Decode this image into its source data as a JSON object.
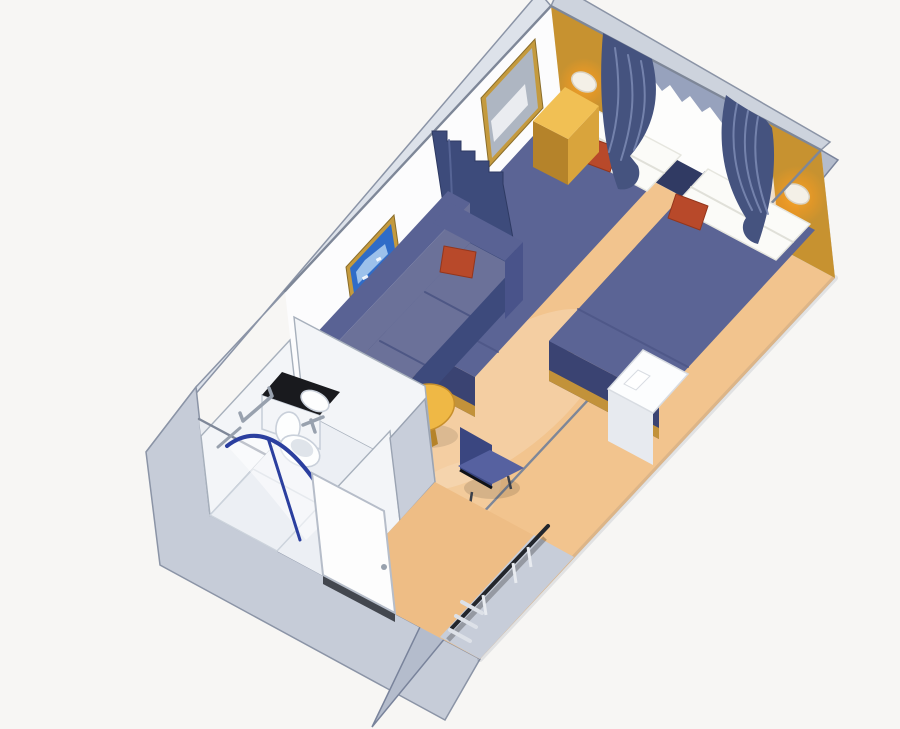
{
  "scene": {
    "title": "cruise-stateroom-3d-floorplan",
    "view": "isometric-cutaway",
    "rooms": [
      "sleeping-area",
      "sitting-area",
      "bathroom",
      "entry-corridor"
    ],
    "furniture": [
      "twin-bed-left",
      "twin-bed-right",
      "nightstand",
      "sofa",
      "coffee-table",
      "desk",
      "desk-chair",
      "wardrobe-closet",
      "vanity-sink",
      "toilet",
      "shower",
      "porthole-window",
      "window-curtains",
      "divider-drape",
      "wall-mirror",
      "framed-picture",
      "wall-sconce-left",
      "wall-sconce-right",
      "entry-door"
    ]
  },
  "palette": {
    "background": "#f7f6f4",
    "shell_left": "#dde2ea",
    "shell_bottom": "#c6ccd8",
    "shell_right": "#b4bccc",
    "shell_rim": "#cdd3dd",
    "wall_white": "#fcfcfd",
    "wall_end": "#e9ecf1",
    "wall_bath": "#f3f5f8",
    "window_backing": "#eef0f4",
    "window_white": "#fdfdfc",
    "gold_wall": "#c79230",
    "gold_top": "#f1c054",
    "gold_front": "#d9a43c",
    "gold_side": "#b5832a",
    "gold_trim": "#c2923a",
    "glow": "#f59b22",
    "lamp": "#f4f0e7",
    "navy_top": "#5b6495",
    "navy_side": "#4b5487",
    "navy_foot": "#3a4372",
    "navy_base": "#303a63",
    "curtain": "#45537f",
    "curtain_fold": "#7d8bb4",
    "valance": "#97a2bd",
    "drape": "#3d4b7b",
    "linen": "#fbfbf8",
    "linen_split": "#d9d9d1",
    "red": "#b8492a",
    "red_edge": "#93361d",
    "frame_gold": "#c49a3e",
    "picture_blue": "#2f6cc8",
    "picture_light": "#a8cbee",
    "mirror_glass": "#aeb6c2",
    "mirror_streak": "#f4f6f8",
    "sofa_seat": "#6b7199",
    "sofa_back": "#596294",
    "sofa_front": "#3d4a7c",
    "sofa_arm": "#49538a",
    "table_top": "#efb845",
    "table_rim": "#c78f2b",
    "pedestal": "#b5832a",
    "chair_seat": "#5661a0",
    "chair_back": "#3a4680",
    "desk_front": "#f5f6f8",
    "desk_side": "#e7eaef",
    "desk_top": "#fcfdfe",
    "carpet": "#f2c48e",
    "carpet_corridor": "#eebd85",
    "bath_floor": "#eceff4",
    "counter": "#191a1e",
    "fixture": "#fdfefe",
    "fixture_shade": "#dfe4ea",
    "shower_rail": "#2b3f9f",
    "metal": "#98a1ae",
    "closet_floor": "#c7cdd9",
    "rod": "#23262c",
    "shelf": "#dde1e8",
    "door": "#fdfdfd",
    "door_frame": "#b6bdc9",
    "threshold": "#43474f"
  }
}
